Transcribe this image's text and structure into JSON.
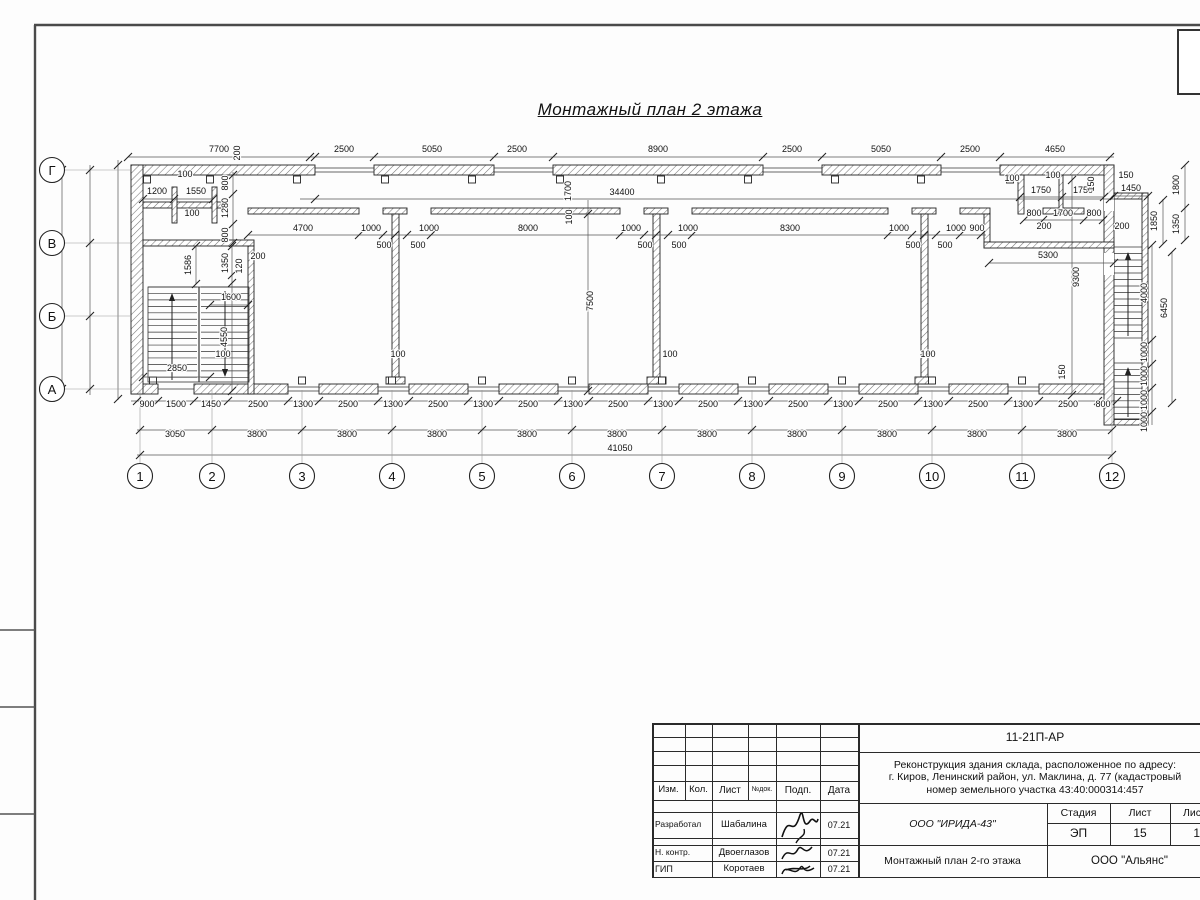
{
  "sheet": {
    "title": "Монтажный план 2 этажа"
  },
  "plan": {
    "axes_bottom": [
      {
        "label": "1",
        "x": 140
      },
      {
        "label": "2",
        "x": 212
      },
      {
        "label": "3",
        "x": 302
      },
      {
        "label": "4",
        "x": 392
      },
      {
        "label": "5",
        "x": 482
      },
      {
        "label": "6",
        "x": 572
      },
      {
        "label": "7",
        "x": 662
      },
      {
        "label": "8",
        "x": 752
      },
      {
        "label": "9",
        "x": 842
      },
      {
        "label": "10",
        "x": 932
      },
      {
        "label": "11",
        "x": 1022
      },
      {
        "label": "12",
        "x": 1112
      }
    ],
    "axes_left": [
      {
        "label": "Г",
        "y": 170
      },
      {
        "label": "В",
        "y": 243
      },
      {
        "label": "Б",
        "y": 316
      },
      {
        "label": "А",
        "y": 389
      }
    ],
    "dims": [
      {
        "t": "7700",
        "x": 219,
        "y": 152
      },
      {
        "t": "200",
        "x": 240,
        "y": 153,
        "r": 1
      },
      {
        "t": "2500",
        "x": 344,
        "y": 152
      },
      {
        "t": "5050",
        "x": 432,
        "y": 152
      },
      {
        "t": "2500",
        "x": 517,
        "y": 152
      },
      {
        "t": "8900",
        "x": 658,
        "y": 152
      },
      {
        "t": "2500",
        "x": 792,
        "y": 152
      },
      {
        "t": "5050",
        "x": 881,
        "y": 152
      },
      {
        "t": "2500",
        "x": 970,
        "y": 152
      },
      {
        "t": "4650",
        "x": 1055,
        "y": 152
      },
      {
        "t": "1700",
        "x": 571,
        "y": 191,
        "r": 1
      },
      {
        "t": "34400",
        "x": 622,
        "y": 195
      },
      {
        "t": "4700",
        "x": 303,
        "y": 231
      },
      {
        "t": "1000",
        "x": 371,
        "y": 231
      },
      {
        "t": "500",
        "x": 384,
        "y": 248
      },
      {
        "t": "500",
        "x": 418,
        "y": 248
      },
      {
        "t": "1000",
        "x": 429,
        "y": 231
      },
      {
        "t": "8000",
        "x": 528,
        "y": 231
      },
      {
        "t": "1000",
        "x": 631,
        "y": 231
      },
      {
        "t": "500",
        "x": 645,
        "y": 248
      },
      {
        "t": "500",
        "x": 679,
        "y": 248
      },
      {
        "t": "1000",
        "x": 688,
        "y": 231
      },
      {
        "t": "8300",
        "x": 790,
        "y": 231
      },
      {
        "t": "1000",
        "x": 899,
        "y": 231
      },
      {
        "t": "500",
        "x": 913,
        "y": 248
      },
      {
        "t": "500",
        "x": 945,
        "y": 248
      },
      {
        "t": "1000",
        "x": 956,
        "y": 231
      },
      {
        "t": "900",
        "x": 977,
        "y": 231
      },
      {
        "t": "100",
        "x": 572,
        "y": 217,
        "r": 1
      },
      {
        "t": "100",
        "x": 185,
        "y": 177
      },
      {
        "t": "1200",
        "x": 157,
        "y": 194
      },
      {
        "t": "1550",
        "x": 196,
        "y": 194
      },
      {
        "t": "100",
        "x": 192,
        "y": 216
      },
      {
        "t": "800",
        "x": 228,
        "y": 183,
        "r": 1
      },
      {
        "t": "1280",
        "x": 228,
        "y": 208,
        "r": 1
      },
      {
        "t": "800",
        "x": 228,
        "y": 235,
        "r": 1
      },
      {
        "t": "1586",
        "x": 191,
        "y": 265,
        "r": 1
      },
      {
        "t": "1350",
        "x": 228,
        "y": 263,
        "r": 1
      },
      {
        "t": "120",
        "x": 242,
        "y": 266,
        "r": 1
      },
      {
        "t": "200",
        "x": 258,
        "y": 259
      },
      {
        "t": "1600",
        "x": 231,
        "y": 300
      },
      {
        "t": "4550",
        "x": 227,
        "y": 337,
        "r": 1
      },
      {
        "t": "100",
        "x": 223,
        "y": 357
      },
      {
        "t": "2850",
        "x": 177,
        "y": 371
      },
      {
        "t": "7500",
        "x": 593,
        "y": 301,
        "r": 1
      },
      {
        "t": "100",
        "x": 398,
        "y": 357
      },
      {
        "t": "100",
        "x": 670,
        "y": 357
      },
      {
        "t": "100",
        "x": 928,
        "y": 357
      },
      {
        "t": "9300",
        "x": 1079,
        "y": 277,
        "r": 1
      },
      {
        "t": "100",
        "x": 1012,
        "y": 181
      },
      {
        "t": "100",
        "x": 1053,
        "y": 178
      },
      {
        "t": "1750",
        "x": 1041,
        "y": 193
      },
      {
        "t": "1750",
        "x": 1083,
        "y": 193
      },
      {
        "t": "150",
        "x": 1094,
        "y": 184,
        "r": 1
      },
      {
        "t": "150",
        "x": 1126,
        "y": 178
      },
      {
        "t": "1450",
        "x": 1131,
        "y": 191
      },
      {
        "t": "800",
        "x": 1034,
        "y": 216
      },
      {
        "t": "1700",
        "x": 1063,
        "y": 216
      },
      {
        "t": "800",
        "x": 1094,
        "y": 216
      },
      {
        "t": "200",
        "x": 1044,
        "y": 229
      },
      {
        "t": "200",
        "x": 1122,
        "y": 229
      },
      {
        "t": "1800",
        "x": 1179,
        "y": 185,
        "r": 1
      },
      {
        "t": "1850",
        "x": 1157,
        "y": 221,
        "r": 1
      },
      {
        "t": "1350",
        "x": 1179,
        "y": 224,
        "r": 1
      },
      {
        "t": "5300",
        "x": 1048,
        "y": 258
      },
      {
        "t": "4000",
        "x": 1147,
        "y": 293,
        "r": 1
      },
      {
        "t": "6450",
        "x": 1167,
        "y": 308,
        "r": 1
      },
      {
        "t": "1000",
        "x": 1147,
        "y": 352,
        "r": 1
      },
      {
        "t": "1000",
        "x": 1147,
        "y": 376,
        "r": 1
      },
      {
        "t": "1000",
        "x": 1147,
        "y": 400,
        "r": 1
      },
      {
        "t": "1000",
        "x": 1147,
        "y": 422,
        "r": 1
      },
      {
        "t": "150",
        "x": 1065,
        "y": 372,
        "r": 1
      },
      {
        "t": "900",
        "x": 147,
        "y": 407
      },
      {
        "t": "1500",
        "x": 176,
        "y": 407
      },
      {
        "t": "1450",
        "x": 211,
        "y": 407
      },
      {
        "t": "2500",
        "x": 258,
        "y": 407
      },
      {
        "t": "1300",
        "x": 303,
        "y": 407
      },
      {
        "t": "2500",
        "x": 348,
        "y": 407
      },
      {
        "t": "1300",
        "x": 393,
        "y": 407
      },
      {
        "t": "2500",
        "x": 438,
        "y": 407
      },
      {
        "t": "1300",
        "x": 483,
        "y": 407
      },
      {
        "t": "2500",
        "x": 528,
        "y": 407
      },
      {
        "t": "1300",
        "x": 573,
        "y": 407
      },
      {
        "t": "2500",
        "x": 618,
        "y": 407
      },
      {
        "t": "1300",
        "x": 663,
        "y": 407
      },
      {
        "t": "2500",
        "x": 708,
        "y": 407
      },
      {
        "t": "1300",
        "x": 753,
        "y": 407
      },
      {
        "t": "2500",
        "x": 798,
        "y": 407
      },
      {
        "t": "1300",
        "x": 843,
        "y": 407
      },
      {
        "t": "2500",
        "x": 888,
        "y": 407
      },
      {
        "t": "1300",
        "x": 933,
        "y": 407
      },
      {
        "t": "2500",
        "x": 978,
        "y": 407
      },
      {
        "t": "1300",
        "x": 1023,
        "y": 407
      },
      {
        "t": "2500",
        "x": 1068,
        "y": 407
      },
      {
        "t": "800",
        "x": 1103,
        "y": 407
      },
      {
        "t": "3050",
        "x": 175,
        "y": 437
      },
      {
        "t": "3800",
        "x": 257,
        "y": 437
      },
      {
        "t": "3800",
        "x": 347,
        "y": 437
      },
      {
        "t": "3800",
        "x": 437,
        "y": 437
      },
      {
        "t": "3800",
        "x": 527,
        "y": 437
      },
      {
        "t": "3800",
        "x": 617,
        "y": 437
      },
      {
        "t": "3800",
        "x": 707,
        "y": 437
      },
      {
        "t": "3800",
        "x": 797,
        "y": 437
      },
      {
        "t": "3800",
        "x": 887,
        "y": 437
      },
      {
        "t": "3800",
        "x": 977,
        "y": 437
      },
      {
        "t": "3800",
        "x": 1067,
        "y": 437
      },
      {
        "t": "41050",
        "x": 620,
        "y": 451
      }
    ]
  },
  "title_block": {
    "doc_number": "11-21П-АР",
    "project_line1": "Реконструкция здания склада, расположенное по адресу:",
    "project_line2": "г. Киров, Ленинский район, ул. Маклина, д. 77 (кадастровый",
    "project_line3": "номер земельного участка 43:40:000314:457",
    "col_izm": "Изм.",
    "col_kol": "Кол.",
    "col_list": "Лист",
    "col_ndok": "№док.",
    "col_podp": "Подп.",
    "col_data": "Дата",
    "row1_role": "Разработал",
    "row1_name": "Шабалина",
    "row1_date": "07.21",
    "row2_role": "Н. контр.",
    "row2_name": "Двоеглазов",
    "row2_date": "07.21",
    "row3_role": "ГИП",
    "row3_name": "Коротаев",
    "row3_date": "07.21",
    "org": "ООО \"ИРИДА-43\"",
    "stage_label": "Стадия",
    "sheet_label": "Лист",
    "sheets_label": "Листов",
    "stage": "ЭП",
    "sheet_num": "15",
    "sheets_total": "18",
    "drawing_name": "Монтажный план 2-го этажа",
    "firm": "ООО \"Альянс\""
  }
}
